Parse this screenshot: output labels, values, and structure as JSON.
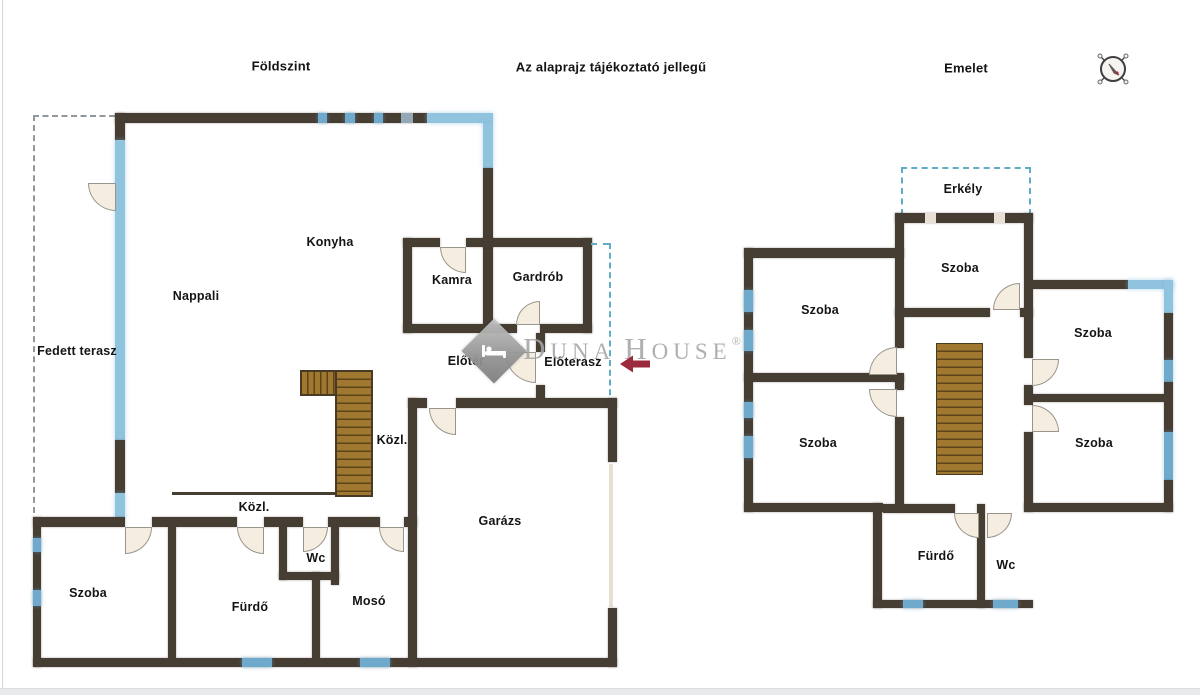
{
  "header": {
    "ground_title": "Földszint",
    "disclaimer": "Az alaprajz tájékoztató jellegű",
    "upper_title": "Emelet"
  },
  "watermark": {
    "brand": "Duna House",
    "w1": "D",
    "w2": "UNA",
    "w3": "H",
    "w4": "OUSE",
    "registered": "®"
  },
  "ground_floor": {
    "rooms": {
      "fedett_terasz": "Fedett terasz",
      "nappali": "Nappali",
      "konyha": "Konyha",
      "kamra": "Kamra",
      "gardrob": "Gardrób",
      "eloter": "Előtér",
      "eloterasz": "Előterasz",
      "kozl_upper": "Közl.",
      "kozl_lower": "Közl.",
      "szoba": "Szoba",
      "furdo": "Fürdő",
      "wc": "Wc",
      "moso": "Mosó",
      "garazs": "Garázs"
    }
  },
  "upper_floor": {
    "rooms": {
      "erkely": "Erkély",
      "szoba_middle": "Szoba",
      "szoba_left_top": "Szoba",
      "szoba_right_top": "Szoba",
      "szoba_left_bottom": "Szoba",
      "szoba_right_bottom": "Szoba",
      "furdo": "Fürdő",
      "wc": "Wc"
    }
  },
  "colors": {
    "wall": "#463d33",
    "window_light": "#8fc3de",
    "window_mid": "#6fa9cb",
    "window_gray": "#93a9b8",
    "stairs": "#a1782f",
    "door_fill": "#f5eddf",
    "terrace_dash": "#90989d",
    "balcony_dash": "#5fadc6",
    "watermark_gray": "#a4a4a4",
    "arrow_red": "#9c2a3e"
  }
}
